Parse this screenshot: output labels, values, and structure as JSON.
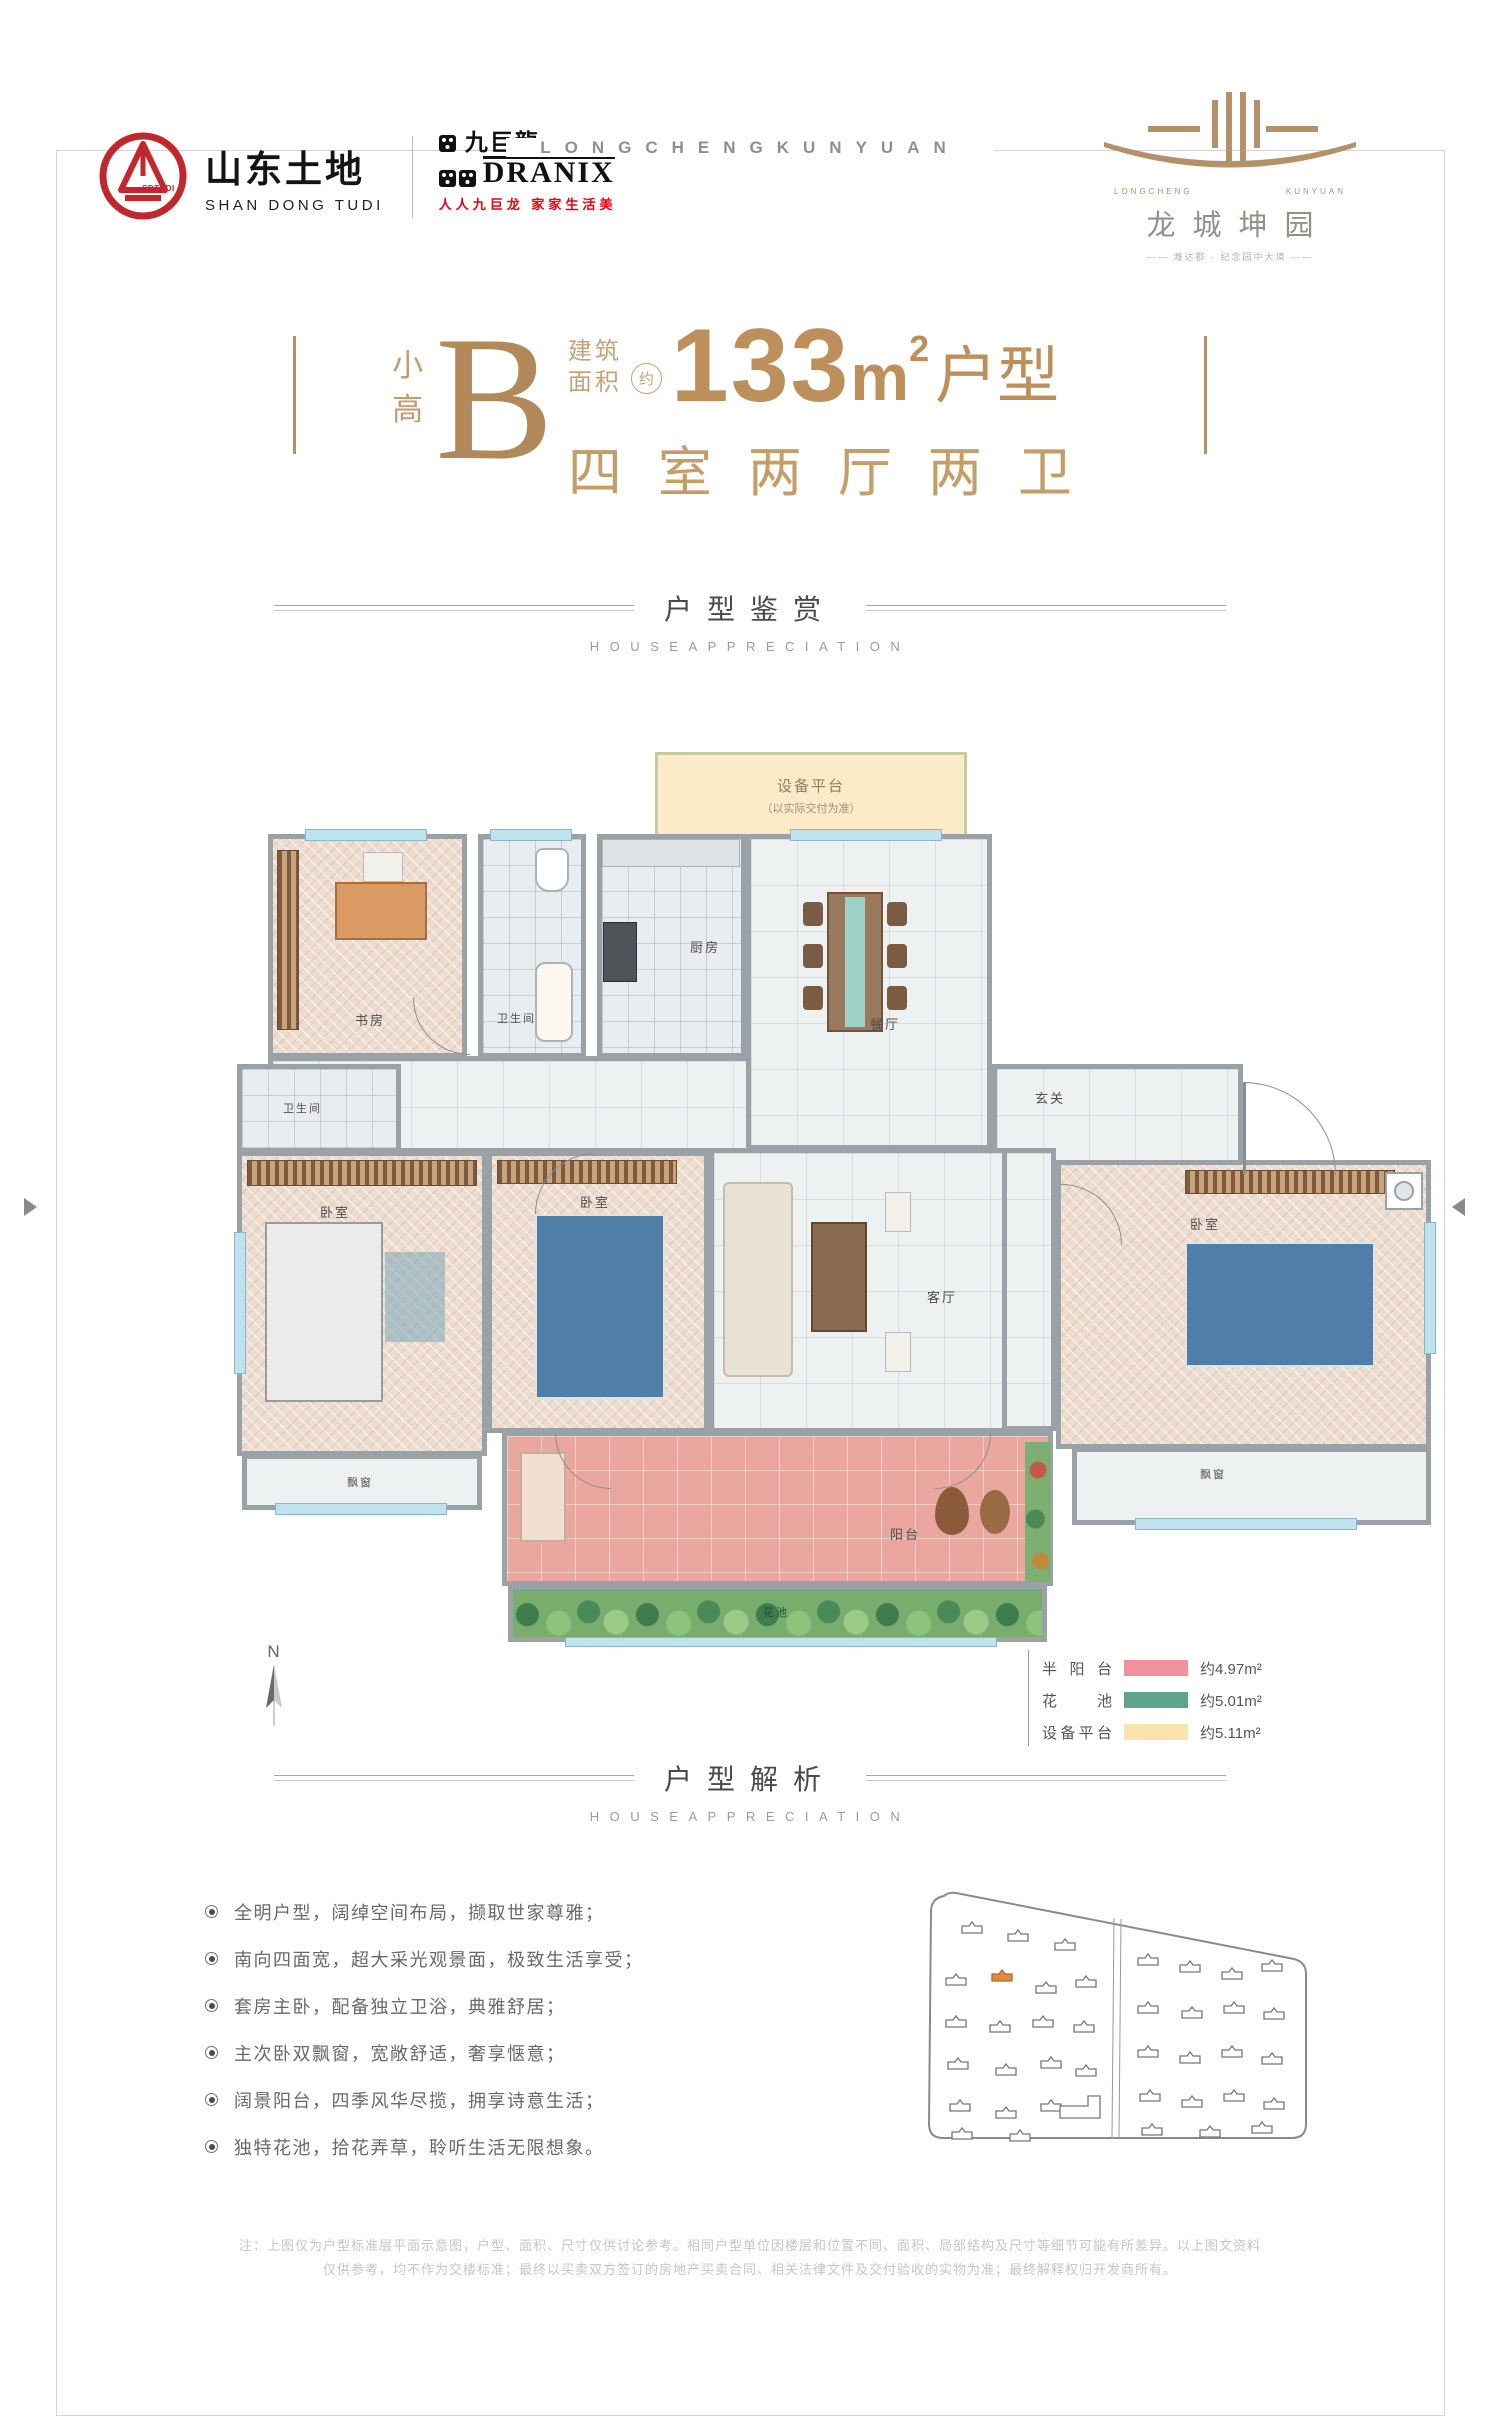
{
  "frame": {
    "top_text": "LONGCHENGKUNYUAN"
  },
  "logos": {
    "sdtudi": {
      "badge": "SDTUDI",
      "cn": "山东土地",
      "en": "SHAN DONG TUDI"
    },
    "dranix": {
      "cn": "九巨龍",
      "en": "DRANIX",
      "tagline": "人人九巨龙 家家生活美"
    },
    "project": {
      "en_left": "LONGCHENG",
      "en_right": "KUNYUAN",
      "cn": "龙城坤园",
      "tagline": "—— 潍达郡 · 纪念园中大境 ——"
    }
  },
  "title": {
    "prefix_top": "小",
    "prefix_bottom": "高",
    "letter": "B",
    "area_word1": "建筑",
    "area_word2": "面积",
    "approx": "约",
    "number": "133",
    "unit": "m",
    "power": "2",
    "suffix": "户型",
    "line2": "四室两厅两卫"
  },
  "sections": {
    "appreciation": {
      "cn": "户型鉴赏",
      "en": "HOUSEAPPRECIATION"
    },
    "analysis": {
      "cn": "户型解析",
      "en": "HOUSEAPPRECIATION"
    }
  },
  "plan": {
    "equipment": {
      "label": "设备平台",
      "note": "（以实际交付为准）"
    },
    "rooms": {
      "study": "书房",
      "bath_top": "卫生间",
      "kitchen": "厨房",
      "dining": "餐厅",
      "foyer": "玄关",
      "bath_left": "卫生间",
      "bedroom_left": "卧室",
      "bedroom_mid": "卧室",
      "living": "客厅",
      "bedroom_right": "卧室",
      "balcony": "阳台",
      "flower": "花池",
      "bay_left": "飘窗",
      "bay_right": "飘窗"
    },
    "compass": "N"
  },
  "legend": {
    "items": [
      {
        "label": "半阳台",
        "value": "约4.97m²",
        "color": "#f0919d"
      },
      {
        "label": "花池",
        "value": "约5.01m²",
        "color": "#5fa58d"
      },
      {
        "label": "设备平台",
        "value": "约5.11m²",
        "color": "#fbe3ae"
      }
    ]
  },
  "features": {
    "items": [
      "全明户型，阔绰空间布局，撷取世家尊雅；",
      "南向四面宽，超大采光观景面，极致生活享受；",
      "套房主卧，配备独立卫浴，典雅舒居；",
      "主次卧双飘窗，宽敞舒适，奢享惬意；",
      "阔景阳台，四季风华尽揽，拥享诗意生活；",
      "独特花池，拾花弄草，聆听生活无限想象。"
    ]
  },
  "disclaimer": {
    "line1": "注：上图仅为户型标准层平面示意图，户型、面积、尺寸仅供讨论参考。相同户型单位因楼层和位置不同、面积、局部结构及尺寸等细节可能有所差异。以上图文资料",
    "line2": "仅供参考，均不作为交楼标准；最终以买卖双方签订的房地产买卖合同、相关法律文件及交付验收的实物为准；最终解释权归开发商所有。"
  }
}
